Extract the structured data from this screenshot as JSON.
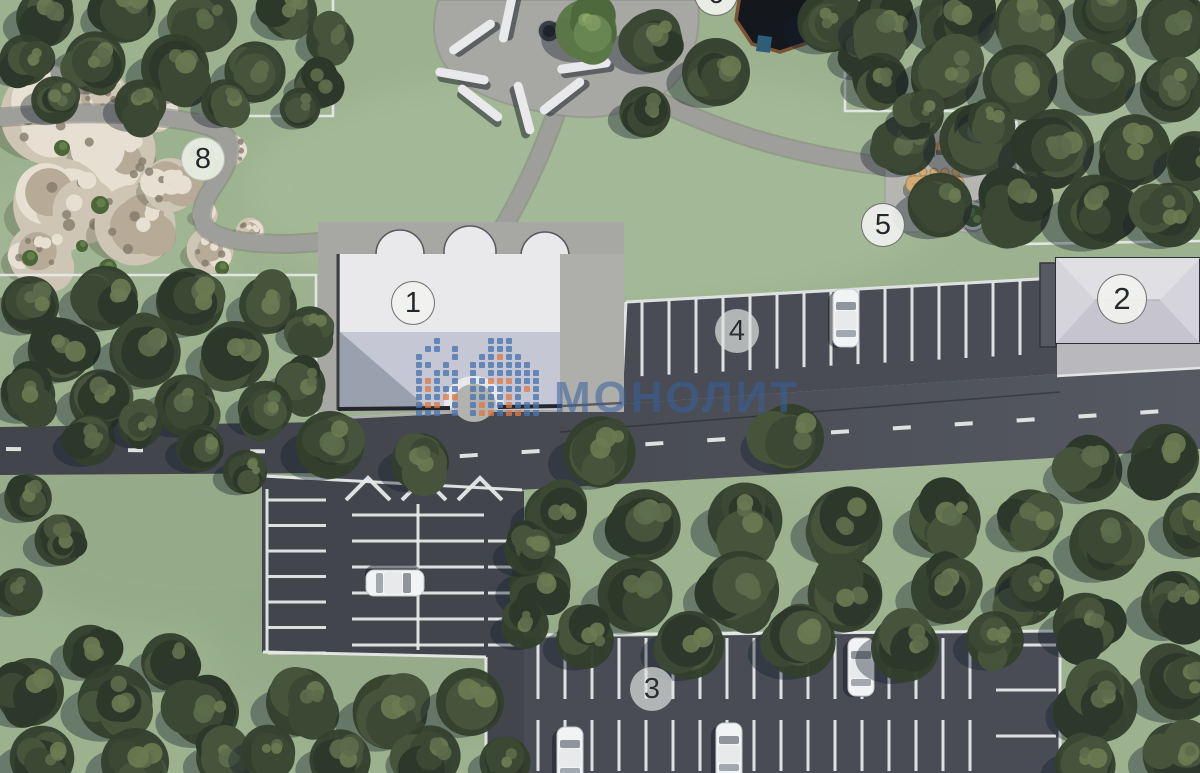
{
  "badges": [
    {
      "id": "area-6",
      "label": "6"
    },
    {
      "id": "area-8",
      "label": "8"
    },
    {
      "id": "area-1",
      "label": "1"
    },
    {
      "id": "area-2",
      "label": "2"
    },
    {
      "id": "area-4",
      "label": "4"
    },
    {
      "id": "area-5",
      "label": "5"
    },
    {
      "id": "area-3",
      "label": "3"
    }
  ],
  "watermark": {
    "text": "МОНОЛИТ",
    "brand_blue": "#4a74ae",
    "brand_orange": "#dd7a48"
  },
  "palette": {
    "grass": "#9cb28f",
    "grass_light": "#abbf9e",
    "grass_dark": "#8aa07f",
    "asphalt": "#494c54",
    "asphalt_light": "#565962",
    "asphalt_dark": "#42454b",
    "marking": "#e7e9e9",
    "path": "#9e9e9a",
    "path_edge": "#83837e",
    "plaza": "#a7a7a3",
    "pad": "#b5b6b2",
    "apron": "#b9b9bd",
    "roof_white": "#e9e9eb",
    "roof_shade": "#c5c8d4",
    "roof_dark": "#99a0ae",
    "edge_dark": "#23262b",
    "roof2": "#d5d4da",
    "roof2_light": "#e0dfe4",
    "roof2_shade": "#c6c5cd",
    "slab_dark": "#575a62",
    "rock_base": "#cfc5b4",
    "rock_light": "#e7e0d2",
    "rock_mid": "#b7ab98",
    "rock_dark": "#857b6b",
    "tree_base": "#33402d",
    "tree_b1": "#2c3829",
    "tree_b2": "#3a4834",
    "tree_b3": "#46543c",
    "tree_hl1": "#5c6d4b",
    "tree_hl2": "#6a7b52",
    "tree_bright": "#5d7747",
    "bush": "#4c6639",
    "bush_hl": "#64804a",
    "shadow": "rgba(22,32,44,0.38)",
    "wood": "#d2ab74",
    "wood_dark": "#a8834f",
    "gazebo": "#14181d",
    "gazebo_rim": "#7b5233",
    "teal": "#2e5d7a",
    "car_body": "#f2f3f4",
    "car_glass": "#8e959d"
  }
}
